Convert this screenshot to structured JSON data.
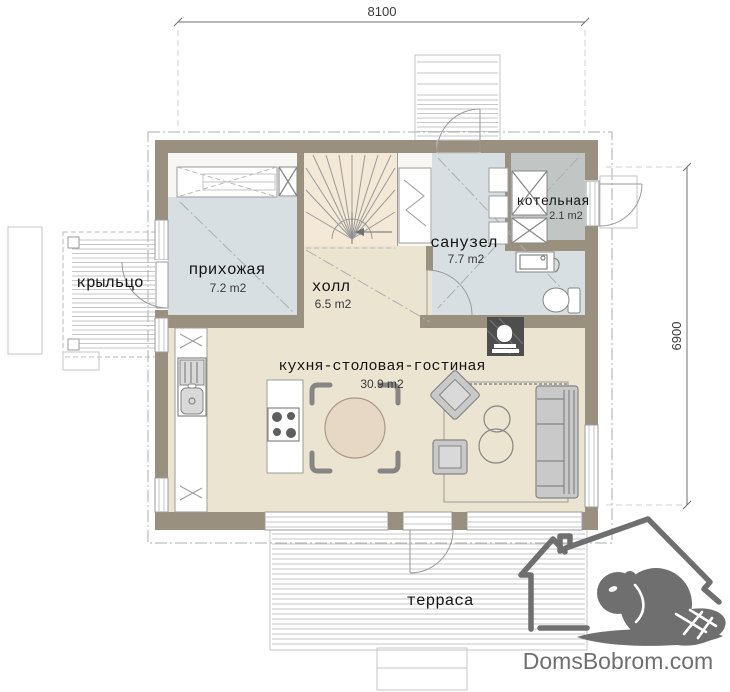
{
  "dimensions": {
    "width": "8100",
    "height": "6900"
  },
  "rooms": {
    "hallway": {
      "name": "прихожая",
      "area": "7.2 m2"
    },
    "hall": {
      "name": "холл",
      "area": "6.5 m2"
    },
    "bathroom": {
      "name": "санузел",
      "area": "7.7 m2"
    },
    "boiler": {
      "name": "котельная",
      "area": "2.1 m2"
    },
    "kitchen_living": {
      "name": "кухня-столовая-гостиная",
      "area": "30.9 m2"
    },
    "porch": {
      "name": "крыльцо"
    },
    "terrace": {
      "name": "терраса"
    }
  },
  "watermark": {
    "text": "DomsBobrom.com"
  },
  "colors": {
    "wall": "#9a9080",
    "floor_main": "#ebe4d1",
    "floor_stair": "#f3e9d6",
    "floor_wet": "#d8dfe2",
    "floor_boiler": "#c1c6c5",
    "furniture": "#c9c9c9",
    "furniture_dark": "#858585",
    "line": "#9b9b9b",
    "table": "#e7d8c5",
    "fireplace": "#4e4e4e",
    "logo": "#6f6f6f"
  }
}
